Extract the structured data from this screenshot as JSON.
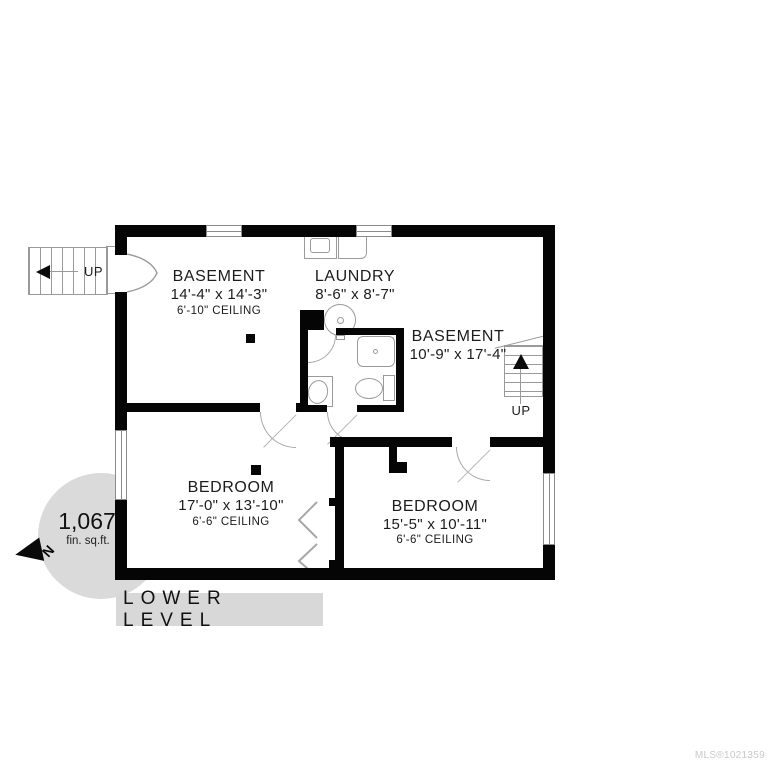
{
  "title_bar": {
    "label": "LOWER LEVEL"
  },
  "watermark": "MLS®1021359",
  "area_badge": {
    "value": "1,067",
    "unit": "fin. sq.ft.",
    "north": "N"
  },
  "rooms": {
    "basement1": {
      "name": "BASEMENT",
      "dims": "14'-4\" x 14'-3\"",
      "ceiling": "6'-10\" CEILING"
    },
    "laundry": {
      "name": "LAUNDRY",
      "dims": "8'-6\" x 8'-7\""
    },
    "basement2": {
      "name": "BASEMENT",
      "dims": "10'-9\" x 17'-4\""
    },
    "bedroom1": {
      "name": "BEDROOM",
      "dims": "17'-0\" x 13'-10\"",
      "ceiling": "6'-6\" CEILING"
    },
    "bedroom2": {
      "name": "BEDROOM",
      "dims": "15'-5\" x 10'-11\"",
      "ceiling": "6'-6\" CEILING"
    }
  },
  "stairs": {
    "upper_left": "UP",
    "right": "UP"
  },
  "colors": {
    "wall": "#050505",
    "badge_bg": "#dadada",
    "title_bg": "#d8d8d8",
    "watermark": "#c9c9c9",
    "fixture_line": "#9a9a9a"
  }
}
